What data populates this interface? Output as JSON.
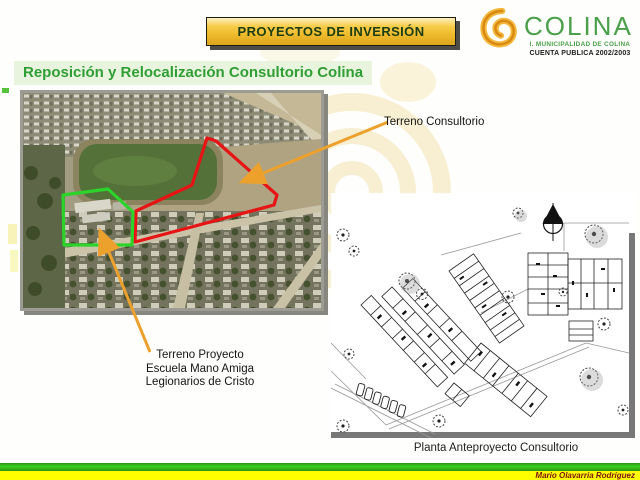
{
  "header": {
    "banner": "PROYECTOS DE INVERSIÓN"
  },
  "logo": {
    "name": "COLINA",
    "subtitle": "I. MUNICIPALIDAD DE COLINA",
    "tagline": "CUENTA PUBLICA 2002/2003",
    "icon": "colina-swirl-icon"
  },
  "slide": {
    "title": "Reposición y Relocalización Consultorio Colina"
  },
  "photo": {
    "label_consultorio": "Terreno Consultorio",
    "label_proyecto_line1": "Terreno Proyecto",
    "label_proyecto_line2": "Escuela Mano Amiga",
    "label_proyecto_line3": "Legionarios de Cristo"
  },
  "plan": {
    "caption": "Planta Anteproyecto Consultorio"
  },
  "footer": {
    "author": "Mario Olavarria Rodríguez"
  },
  "colors": {
    "banner_gold": "#eeba2b",
    "banner_text_green": "#1b3d14",
    "logo_green": "#4aa04a",
    "logo_swirl_orange": "#e89c1e",
    "title_green": "#2f9e33",
    "title_highlight": "#e9f4df",
    "outline_red": "#e61414",
    "outline_green": "#2bd32b",
    "arrow_orange": "#eca12d",
    "footer_green": "#3ecf1f",
    "footer_yellow": "#ffff00",
    "footer_text_maroon": "#7d1408"
  }
}
